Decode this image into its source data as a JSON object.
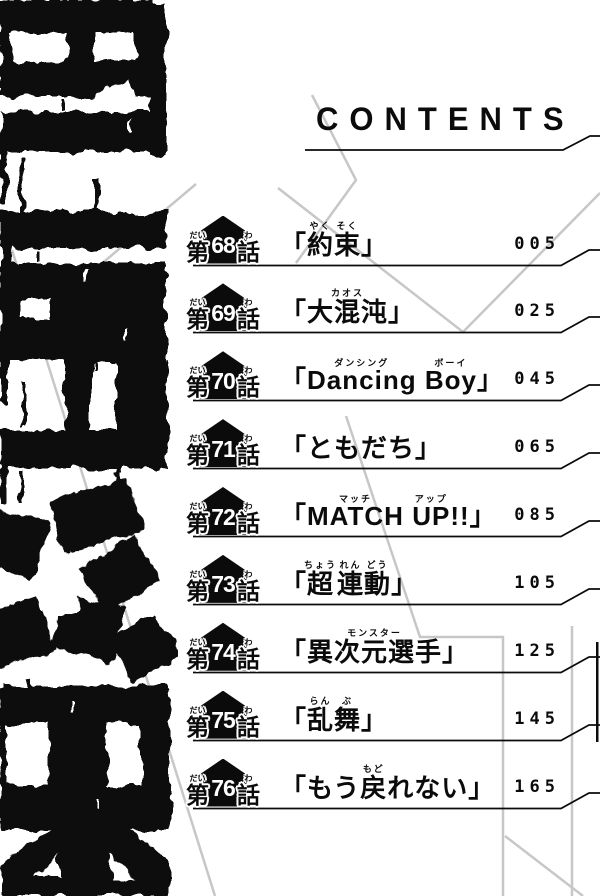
{
  "page_title": "CONTENTS",
  "labels": {
    "open_bracket": "「",
    "close_bracket": "」",
    "chapter_prefix": "第",
    "chapter_prefix_ruby": "だい",
    "chapter_suffix": "話",
    "chapter_suffix_ruby": "わ"
  },
  "logo": {
    "description": "distressed black vertical series wordmark with soccer-ball pentagon motif"
  },
  "colors": {
    "ink": "#0b0b0b",
    "background": "#ffffff",
    "accent_gray": "#c7c7c7"
  },
  "entries": [
    {
      "number": "68",
      "title": "約束",
      "page": "005",
      "segments": [
        {
          "text": "約",
          "ruby": "やく"
        },
        {
          "text": "束",
          "ruby": "そく"
        }
      ]
    },
    {
      "number": "69",
      "title": "大混沌",
      "page": "025",
      "segments": [
        {
          "text": "大混沌",
          "ruby": "カオス"
        }
      ]
    },
    {
      "number": "70",
      "title": "Dancing Boy",
      "page": "045",
      "segments": [
        {
          "text": "Dancing",
          "ruby": "ダンシング"
        },
        {
          "text": " ",
          "ruby": ""
        },
        {
          "text": "Boy",
          "ruby": "ボーイ"
        }
      ]
    },
    {
      "number": "71",
      "title": "ともだち",
      "page": "065",
      "segments": [
        {
          "text": "ともだち",
          "ruby": ""
        }
      ]
    },
    {
      "number": "72",
      "title": "MATCH UP!!",
      "page": "085",
      "segments": [
        {
          "text": "MATCH",
          "ruby": "マッチ"
        },
        {
          "text": " ",
          "ruby": ""
        },
        {
          "text": "UP",
          "ruby": "アップ"
        },
        {
          "text": "!!",
          "ruby": ""
        }
      ]
    },
    {
      "number": "73",
      "title": "超連動",
      "page": "105",
      "segments": [
        {
          "text": "超",
          "ruby": "ちょう"
        },
        {
          "text": "連",
          "ruby": "れん"
        },
        {
          "text": "動",
          "ruby": "どう"
        }
      ]
    },
    {
      "number": "74",
      "title": "異次元選手",
      "page": "125",
      "segments": [
        {
          "text": "異次元選手",
          "ruby": "モンスター"
        }
      ]
    },
    {
      "number": "75",
      "title": "乱舞",
      "page": "145",
      "segments": [
        {
          "text": "乱",
          "ruby": "らん"
        },
        {
          "text": "舞",
          "ruby": "ぶ"
        }
      ]
    },
    {
      "number": "76",
      "title": "もう戻れない",
      "page": "165",
      "segments": [
        {
          "text": "もう",
          "ruby": ""
        },
        {
          "text": "戻",
          "ruby": "もど"
        },
        {
          "text": "れない",
          "ruby": ""
        }
      ]
    }
  ]
}
